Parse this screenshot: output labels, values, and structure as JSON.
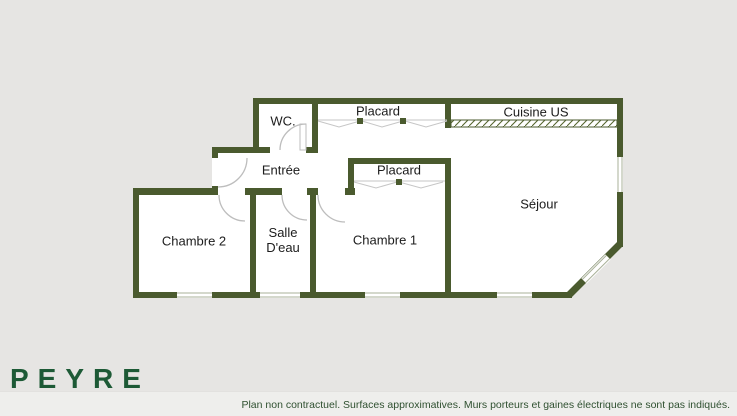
{
  "plan": {
    "rooms": [
      {
        "id": "wc",
        "label": "WC."
      },
      {
        "id": "placard-hall",
        "label": "Placard"
      },
      {
        "id": "cuisine",
        "label": "Cuisine US"
      },
      {
        "id": "entree",
        "label": "Entrée"
      },
      {
        "id": "placard-chambre1",
        "label": "Placard"
      },
      {
        "id": "sejour",
        "label": "Séjour"
      },
      {
        "id": "chambre2",
        "label": "Chambre 2"
      },
      {
        "id": "salle-deau",
        "label": "Salle D'eau"
      },
      {
        "id": "chambre1",
        "label": "Chambre 1"
      }
    ]
  },
  "branding": {
    "name": "PEYRE",
    "tagline": "IMMOBILIER"
  },
  "footer": {
    "disclaimer": "Plan non contractuel. Surfaces approximatives. Murs porteurs et gaines électriques ne sont pas indiqués."
  },
  "colors": {
    "background": "#e6e5e3",
    "floor": "#ffffff",
    "wall": "#4a5a2e",
    "door_line": "#bdbdbd",
    "window_line": "#a9b199",
    "hatch_line": "#55652f",
    "logo_green": "#1d5a36",
    "disclaimer_text": "#2f5030",
    "footer_bg": "#eeeeec"
  }
}
